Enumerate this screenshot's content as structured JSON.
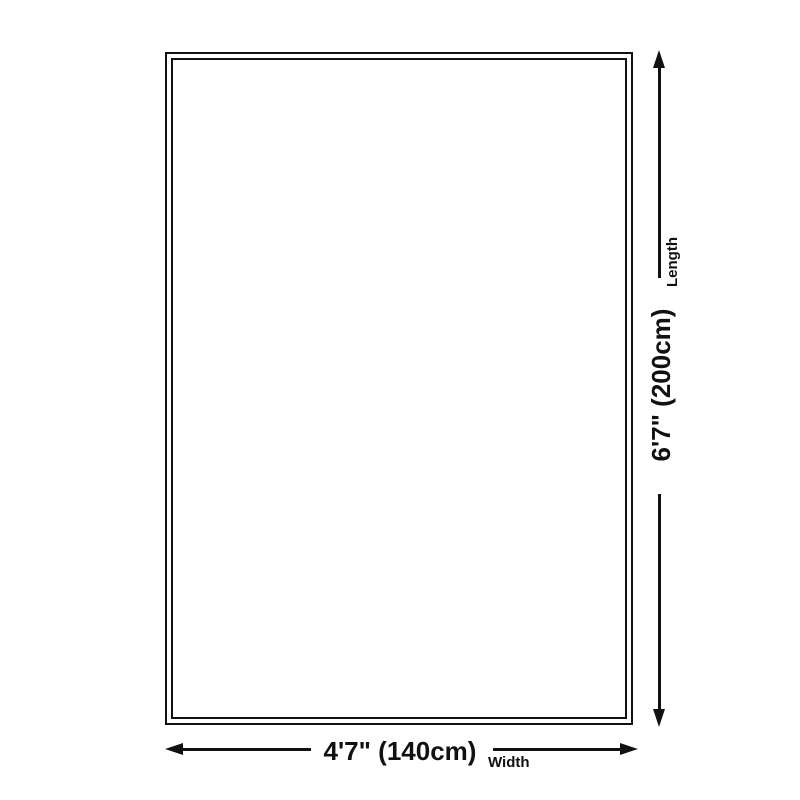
{
  "dimensions": {
    "width": {
      "value": "4'7\" (140cm)",
      "label": "Width"
    },
    "length": {
      "value": "6'7\" (200cm)",
      "label": "Length"
    }
  },
  "colors": {
    "line": "#111111",
    "background": "#ffffff"
  }
}
